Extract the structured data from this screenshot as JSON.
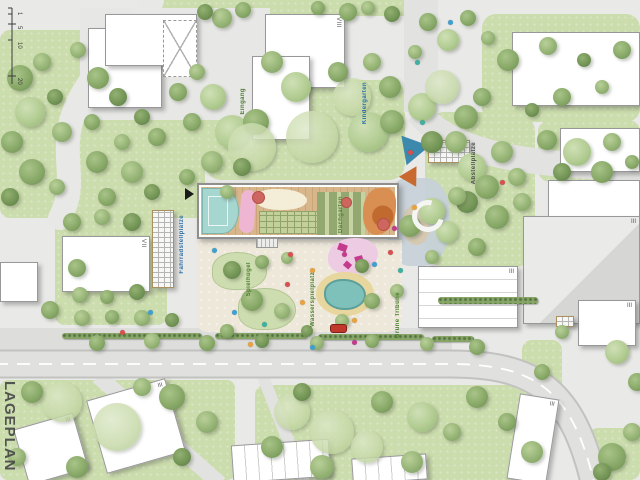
{
  "plan": {
    "name": "LAGEPLAN"
  },
  "scalebar": {
    "ticks": [
      "1",
      "5",
      "10",
      "20"
    ]
  },
  "labels": {
    "eingang": "Eingang",
    "kindergarten": "Kindergarten",
    "dachgarten": "Dachgarten",
    "abstellplaetze": "Abstellplätze",
    "fahrradstellplaetze": "Fahrradstellplätze",
    "spielhuegel": "Spielhügel",
    "wasserspielplatz": "Wasserspielplatz",
    "gruene_tribuene": "Grüne Tribüne"
  },
  "colors": {
    "lawn": "#cbdcad",
    "road": "#e0e0de",
    "road_edge": "#c2c2c0",
    "court": "#a6d6d0",
    "deck": "#d7b68b",
    "pond": "#7ec0ba",
    "accent_pink": "#efb6d3",
    "accent_orange": "#d98e52",
    "car": "#c0392b"
  },
  "buildings": [
    {
      "x": 88,
      "y": 28,
      "w": 74,
      "h": 80,
      "storeys": ""
    },
    {
      "x": 105,
      "y": 14,
      "w": 92,
      "h": 52,
      "storeys": ""
    },
    {
      "x": 163,
      "y": 20,
      "w": 34,
      "h": 57,
      "type": "xbrace",
      "storeys": ""
    },
    {
      "x": 265,
      "y": 14,
      "w": 80,
      "h": 74,
      "storeys": "VIII",
      "sv": 1
    },
    {
      "x": 252,
      "y": 56,
      "w": 58,
      "h": 84,
      "storeys": ""
    },
    {
      "x": 512,
      "y": 32,
      "w": 128,
      "h": 74,
      "storeys": ""
    },
    {
      "x": 560,
      "y": 128,
      "w": 80,
      "h": 44,
      "storeys": ""
    },
    {
      "x": 548,
      "y": 180,
      "w": 92,
      "h": 40,
      "storeys": ""
    },
    {
      "x": 523,
      "y": 216,
      "w": 117,
      "h": 108,
      "type": "gray",
      "storeys": "III"
    },
    {
      "x": 578,
      "y": 300,
      "w": 58,
      "h": 46,
      "storeys": "III"
    },
    {
      "x": 62,
      "y": 236,
      "w": 88,
      "h": 56,
      "storeys": "VII",
      "sv": 1
    },
    {
      "x": 0,
      "y": 262,
      "w": 38,
      "h": 40,
      "storeys": ""
    },
    {
      "x": 95,
      "y": 388,
      "w": 82,
      "h": 76,
      "rot": -16,
      "storeys": "III"
    },
    {
      "x": 20,
      "y": 420,
      "w": 62,
      "h": 58,
      "rot": -16,
      "storeys": "III"
    },
    {
      "x": 232,
      "y": 442,
      "w": 98,
      "h": 38,
      "rot": -4,
      "type": "rows-v",
      "storeys": ""
    },
    {
      "x": 352,
      "y": 456,
      "w": 75,
      "h": 26,
      "rot": -4,
      "type": "rows-v",
      "storeys": ""
    },
    {
      "x": 513,
      "y": 396,
      "w": 40,
      "h": 86,
      "rot": 9,
      "storeys": "III"
    },
    {
      "x": 418,
      "y": 266,
      "w": 100,
      "h": 62,
      "type": "rows-h",
      "storeys": "III"
    },
    {
      "x": 152,
      "y": 210,
      "w": 22,
      "h": 78,
      "type": "rack",
      "storeys": ""
    },
    {
      "x": 428,
      "y": 140,
      "w": 42,
      "h": 23,
      "type": "rack",
      "storeys": ""
    },
    {
      "x": 556,
      "y": 316,
      "w": 18,
      "h": 11,
      "type": "rack",
      "storeys": ""
    }
  ],
  "hedges": [
    [
      62,
      333,
      140,
      6
    ],
    [
      215,
      333,
      92,
      6
    ],
    [
      318,
      334,
      106,
      6
    ],
    [
      438,
      297,
      100,
      7
    ],
    [
      432,
      336,
      42,
      6
    ]
  ],
  "trees": [
    [
      20,
      78,
      13,
      1
    ],
    [
      42,
      62,
      9,
      0
    ],
    [
      30,
      112,
      15,
      2
    ],
    [
      12,
      142,
      11,
      1
    ],
    [
      55,
      97,
      8,
      3
    ],
    [
      78,
      50,
      8,
      0
    ],
    [
      98,
      78,
      11,
      1
    ],
    [
      118,
      97,
      9,
      3
    ],
    [
      62,
      132,
      10,
      0
    ],
    [
      92,
      122,
      8,
      1
    ],
    [
      32,
      172,
      13,
      1
    ],
    [
      10,
      197,
      9,
      3
    ],
    [
      57,
      187,
      8,
      0
    ],
    [
      97,
      162,
      11,
      1
    ],
    [
      122,
      142,
      8,
      0
    ],
    [
      142,
      117,
      8,
      3
    ],
    [
      157,
      137,
      9,
      1
    ],
    [
      132,
      172,
      11,
      0
    ],
    [
      107,
      197,
      9,
      1
    ],
    [
      152,
      192,
      8,
      3
    ],
    [
      178,
      92,
      9,
      1
    ],
    [
      197,
      72,
      8,
      0
    ],
    [
      213,
      97,
      13,
      2
    ],
    [
      192,
      122,
      9,
      1
    ],
    [
      222,
      18,
      10,
      0
    ],
    [
      243,
      10,
      8,
      1
    ],
    [
      205,
      12,
      8,
      3
    ],
    [
      232,
      132,
      17,
      2
    ],
    [
      256,
      122,
      13,
      1
    ],
    [
      252,
      147,
      24,
      4
    ],
    [
      312,
      137,
      26,
      4
    ],
    [
      296,
      87,
      15,
      2
    ],
    [
      272,
      62,
      11,
      0
    ],
    [
      352,
      97,
      19,
      4
    ],
    [
      338,
      72,
      10,
      1
    ],
    [
      372,
      62,
      9,
      0
    ],
    [
      390,
      87,
      11,
      1
    ],
    [
      368,
      132,
      20,
      2
    ],
    [
      392,
      122,
      12,
      1
    ],
    [
      212,
      162,
      11,
      0
    ],
    [
      187,
      177,
      8,
      1
    ],
    [
      242,
      167,
      9,
      3
    ],
    [
      227,
      192,
      7,
      0
    ],
    [
      422,
      107,
      14,
      2
    ],
    [
      442,
      87,
      17,
      4
    ],
    [
      466,
      117,
      12,
      1
    ],
    [
      456,
      142,
      11,
      0
    ],
    [
      482,
      97,
      9,
      1
    ],
    [
      432,
      142,
      11,
      3
    ],
    [
      472,
      167,
      14,
      2
    ],
    [
      502,
      152,
      11,
      0
    ],
    [
      487,
      187,
      12,
      1
    ],
    [
      517,
      177,
      9,
      0
    ],
    [
      467,
      202,
      11,
      3
    ],
    [
      497,
      217,
      12,
      1
    ],
    [
      522,
      202,
      9,
      0
    ],
    [
      447,
      232,
      11,
      2
    ],
    [
      477,
      247,
      9,
      1
    ],
    [
      432,
      257,
      7,
      0
    ],
    [
      508,
      60,
      11,
      1
    ],
    [
      548,
      46,
      9,
      0
    ],
    [
      584,
      60,
      7,
      3
    ],
    [
      622,
      50,
      9,
      1
    ],
    [
      602,
      87,
      7,
      0
    ],
    [
      562,
      97,
      9,
      1
    ],
    [
      532,
      110,
      7,
      3
    ],
    [
      547,
      140,
      10,
      1
    ],
    [
      577,
      152,
      14,
      2
    ],
    [
      612,
      142,
      9,
      0
    ],
    [
      632,
      162,
      7,
      1
    ],
    [
      562,
      172,
      9,
      3
    ],
    [
      602,
      172,
      11,
      1
    ],
    [
      72,
      222,
      9,
      1
    ],
    [
      102,
      217,
      8,
      0
    ],
    [
      132,
      222,
      9,
      3
    ],
    [
      77,
      268,
      9,
      1
    ],
    [
      80,
      295,
      8,
      0
    ],
    [
      107,
      297,
      7,
      1
    ],
    [
      137,
      292,
      8,
      3
    ],
    [
      50,
      310,
      9,
      1
    ],
    [
      82,
      318,
      8,
      0
    ],
    [
      112,
      317,
      7,
      1
    ],
    [
      142,
      318,
      8,
      0
    ],
    [
      172,
      320,
      7,
      3
    ],
    [
      97,
      343,
      8,
      1
    ],
    [
      152,
      341,
      8,
      0
    ],
    [
      207,
      343,
      8,
      1
    ],
    [
      262,
      341,
      7,
      3
    ],
    [
      317,
      343,
      7,
      0
    ],
    [
      372,
      341,
      7,
      1
    ],
    [
      427,
      344,
      7,
      0
    ],
    [
      477,
      347,
      8,
      1
    ],
    [
      232,
      270,
      9,
      3
    ],
    [
      262,
      262,
      7,
      1
    ],
    [
      287,
      258,
      6,
      0
    ],
    [
      252,
      300,
      11,
      1
    ],
    [
      282,
      311,
      8,
      0
    ],
    [
      227,
      331,
      7,
      1
    ],
    [
      307,
      331,
      6,
      3
    ],
    [
      342,
      321,
      7,
      0
    ],
    [
      372,
      301,
      8,
      1
    ],
    [
      397,
      291,
      7,
      0
    ],
    [
      362,
      266,
      7,
      3
    ],
    [
      410,
      226,
      11,
      1
    ],
    [
      432,
      211,
      13,
      2
    ],
    [
      457,
      196,
      9,
      0
    ],
    [
      62,
      402,
      20,
      4
    ],
    [
      117,
      427,
      24,
      4
    ],
    [
      172,
      397,
      13,
      1
    ],
    [
      207,
      422,
      11,
      0
    ],
    [
      32,
      392,
      11,
      1
    ],
    [
      17,
      457,
      9,
      0
    ],
    [
      77,
      467,
      11,
      1
    ],
    [
      182,
      457,
      9,
      3
    ],
    [
      142,
      387,
      9,
      0
    ],
    [
      292,
      412,
      18,
      4
    ],
    [
      332,
      432,
      22,
      4
    ],
    [
      272,
      447,
      11,
      1
    ],
    [
      322,
      467,
      12,
      0
    ],
    [
      382,
      402,
      11,
      1
    ],
    [
      422,
      417,
      15,
      2
    ],
    [
      452,
      432,
      9,
      0
    ],
    [
      477,
      397,
      11,
      1
    ],
    [
      367,
      447,
      16,
      4
    ],
    [
      412,
      462,
      11,
      0
    ],
    [
      302,
      392,
      9,
      3
    ],
    [
      507,
      422,
      9,
      1
    ],
    [
      532,
      452,
      11,
      0
    ],
    [
      612,
      457,
      14,
      1
    ],
    [
      632,
      432,
      9,
      0
    ],
    [
      617,
      352,
      12,
      2
    ],
    [
      637,
      382,
      9,
      1
    ],
    [
      562,
      332,
      7,
      0
    ],
    [
      542,
      372,
      8,
      1
    ],
    [
      602,
      472,
      9,
      3
    ],
    [
      428,
      22,
      9,
      1
    ],
    [
      415,
      52,
      7,
      0
    ],
    [
      448,
      40,
      11,
      2
    ],
    [
      468,
      18,
      8,
      1
    ],
    [
      488,
      38,
      7,
      0
    ],
    [
      348,
      12,
      9,
      1
    ],
    [
      368,
      8,
      7,
      0
    ],
    [
      392,
      14,
      8,
      3
    ],
    [
      318,
      8,
      7,
      1
    ]
  ],
  "dots": [
    [
      212,
      248,
      "#3fa0d0"
    ],
    [
      288,
      252,
      "#d94f4f"
    ],
    [
      300,
      300,
      "#e8a23f"
    ],
    [
      262,
      322,
      "#3fb0a0"
    ],
    [
      342,
      252,
      "#c43a8c"
    ],
    [
      372,
      262,
      "#3fa0d0"
    ],
    [
      388,
      250,
      "#d94f4f"
    ],
    [
      310,
      268,
      "#e8a23f"
    ],
    [
      398,
      268,
      "#3fb0a0"
    ],
    [
      285,
      282,
      "#d94f4f"
    ],
    [
      232,
      310,
      "#3fa0d0"
    ],
    [
      352,
      318,
      "#e8a23f"
    ],
    [
      392,
      226,
      "#c43a8c"
    ],
    [
      420,
      120,
      "#3fb0a0"
    ],
    [
      408,
      150,
      "#d94f4f"
    ],
    [
      448,
      20,
      "#3fa0d0"
    ],
    [
      415,
      60,
      "#3fb0a0"
    ],
    [
      412,
      205,
      "#e8a23f"
    ],
    [
      500,
      180,
      "#d94f4f"
    ],
    [
      310,
      345,
      "#3fa0d0"
    ],
    [
      248,
      342,
      "#e8a23f"
    ],
    [
      352,
      340,
      "#c43a8c"
    ],
    [
      148,
      310,
      "#3fa0d0"
    ],
    [
      120,
      330,
      "#d94f4f"
    ]
  ],
  "car": {
    "x": 330,
    "y": 324,
    "color": "#c0392b"
  }
}
